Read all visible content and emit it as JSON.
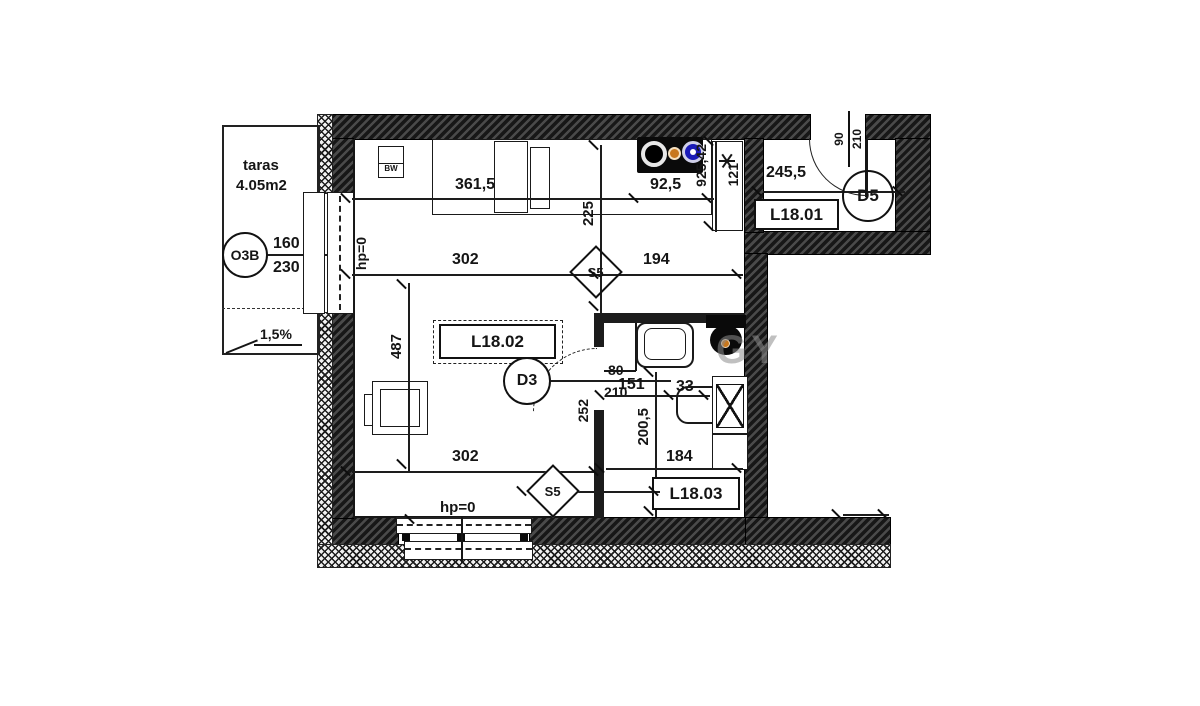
{
  "colors": {
    "burner_orange": "#c8771c",
    "burner_blue": "#1a1ab8",
    "wall": "#1e1e1e",
    "watermark_gray": "#8d8d8d"
  },
  "watermark": {
    "text": "GY"
  },
  "terrace": {
    "name": "taras",
    "area": "4.05m2",
    "slope": "1,5%"
  },
  "window_o3b": {
    "tag": "O3B",
    "width": "160",
    "height": "230"
  },
  "door_d3": {
    "tag": "D3",
    "width": "80",
    "height": "210"
  },
  "door_d5": {
    "tag": "D5",
    "width": "90",
    "height": "210"
  },
  "rooms": {
    "hall": {
      "id": "L18.01"
    },
    "living": {
      "id": "L18.02"
    },
    "bath": {
      "id": "L18.03"
    }
  },
  "labels": {
    "bw": "BW",
    "hp_window": "hp=0",
    "hp_door": "hp=0",
    "s5_top": "S5",
    "s5_bottom": "S5"
  },
  "dims": {
    "kitchen_run": "361,5",
    "hob_width": "92,5",
    "hall_width": "245,5",
    "kitchen_depth": "225",
    "shaft": "925,42",
    "wall_seg": "121",
    "living_width": "302",
    "kitchen_width": "194",
    "living_depth": "487",
    "living_width_bottom": "302",
    "bath_wall": "252",
    "bath_depth": "200,5",
    "bath_width_top": "151",
    "bath_fixture": "33",
    "bath_width": "184"
  }
}
